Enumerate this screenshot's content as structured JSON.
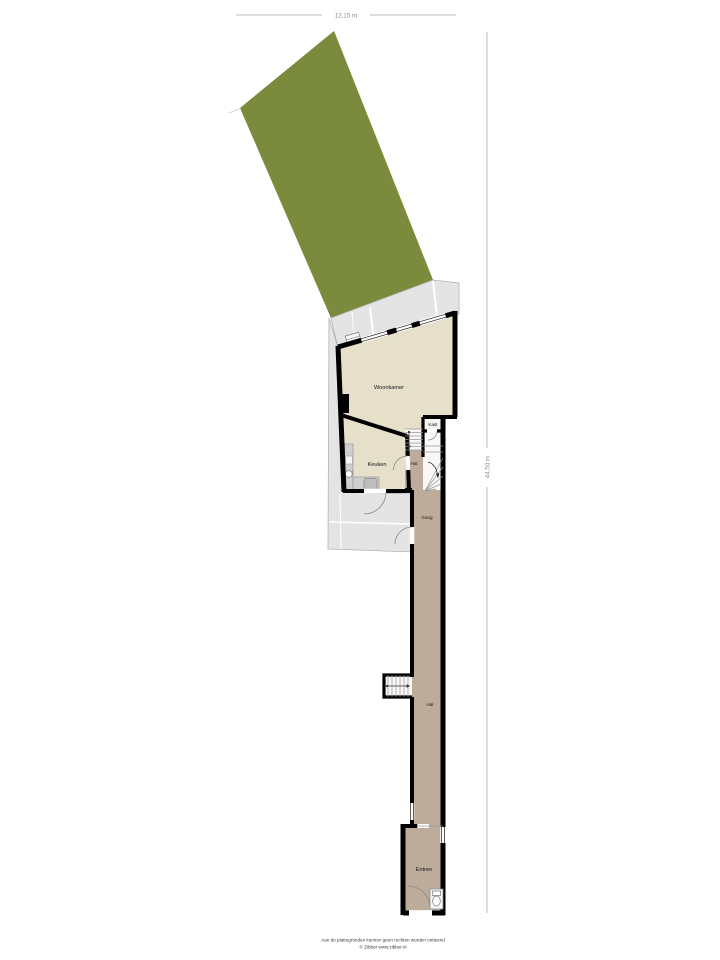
{
  "dimensions": {
    "width_label": "12,15 m",
    "height_label": "44,50 m"
  },
  "rooms": {
    "woonkamer": "Woonkamer",
    "keuken": "Keuken",
    "kast": "Kast",
    "hal": "Hal",
    "gang": "Gang",
    "hal2": "Hal",
    "entree": "Entree"
  },
  "footer": {
    "disclaimer": "Aan de plattegronden kunnen geen rechten worden ontleend",
    "copyright": "© Zibber www.zibber.nl"
  },
  "colors": {
    "garden": "#7d9240",
    "terrace": "#e4e4e4",
    "floor_light": "#e6dfc9",
    "floor_dark": "#beac9b",
    "wall": "#000000"
  },
  "icons": {
    "toilet": "toilet-icon",
    "sink": "sink-icon",
    "stove": "stove-icon",
    "stairs_arrow": "stairs-arrow-icon"
  }
}
